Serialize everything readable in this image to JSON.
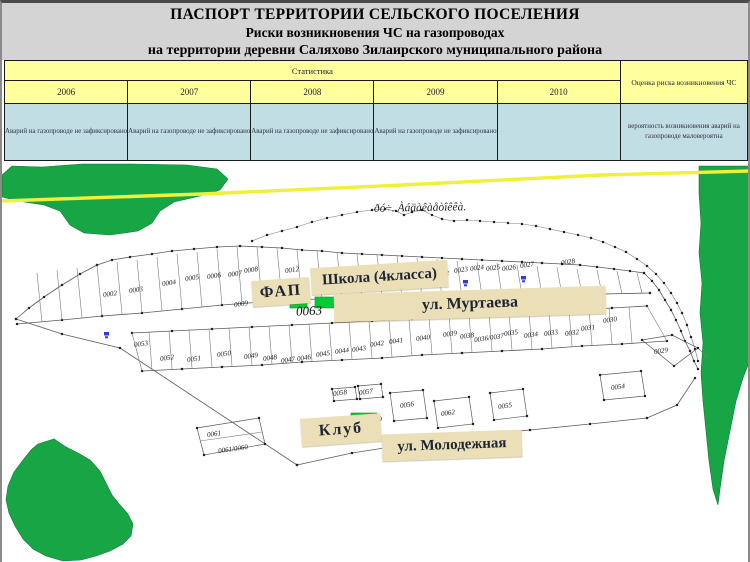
{
  "title": {
    "line1": "ПАСПОРТ ТЕРРИТОРИИ СЕЛЬСКОГО ПОСЕЛЕНИЯ",
    "line2": "Риски возникновения ЧС на газопроводах",
    "line3": "на территории деревни Саляхово Зилаирского муниципального района"
  },
  "table": {
    "stats_header": "Статистика",
    "risk_header": "Оценка риска возникновения ЧС",
    "years": [
      "2006",
      "2007",
      "2008",
      "2009",
      "2010"
    ],
    "incident_rows": [
      "Аварий на газопроводе не зафиксировано",
      "Аварий на газопроводе не зафиксировано",
      "Аварий на газопроводе не зафиксировано",
      "Аварий на газопроводе не зафиксировано",
      ""
    ],
    "risk_value": "вероятность возникновения аварий на газопроводе маловероятна"
  },
  "map": {
    "stream_label": "ðó÷. Àáäàêàåòîêêà.",
    "block_number": "0063",
    "fap_label": "ФАП",
    "school_label": "Школа (4класса)",
    "murtaeva_label": "ул. Муртаева",
    "klub_label": "Клуб",
    "molodezh_label": "ул. Молодежная",
    "parcels": [
      {
        "n": "0002",
        "x": 108,
        "y": 291
      },
      {
        "n": "0003",
        "x": 134,
        "y": 287
      },
      {
        "n": "0004",
        "x": 167,
        "y": 280
      },
      {
        "n": "0005",
        "x": 190,
        "y": 275
      },
      {
        "n": "0006",
        "x": 212,
        "y": 273
      },
      {
        "n": "0007",
        "x": 233,
        "y": 271
      },
      {
        "n": "0008",
        "x": 249,
        "y": 267
      },
      {
        "n": "0009",
        "x": 239,
        "y": 301
      },
      {
        "n": "0012",
        "x": 290,
        "y": 267
      },
      {
        "n": "0021",
        "x": 423,
        "y": 270
      },
      {
        "n": "0022",
        "x": 440,
        "y": 271
      },
      {
        "n": "0023",
        "x": 459,
        "y": 267
      },
      {
        "n": "0024",
        "x": 475,
        "y": 265
      },
      {
        "n": "0025",
        "x": 491,
        "y": 265
      },
      {
        "n": "0026",
        "x": 507,
        "y": 265
      },
      {
        "n": "0027",
        "x": 525,
        "y": 262
      },
      {
        "n": "0028",
        "x": 566,
        "y": 259
      },
      {
        "n": "0029",
        "x": 659,
        "y": 348
      },
      {
        "n": "0030",
        "x": 608,
        "y": 317
      },
      {
        "n": "0031",
        "x": 586,
        "y": 325
      },
      {
        "n": "0032",
        "x": 570,
        "y": 330
      },
      {
        "n": "0033",
        "x": 549,
        "y": 330
      },
      {
        "n": "0034",
        "x": 529,
        "y": 332
      },
      {
        "n": "0035",
        "x": 509,
        "y": 330
      },
      {
        "n": "0036/0037",
        "x": 487,
        "y": 335
      },
      {
        "n": "0038",
        "x": 465,
        "y": 333
      },
      {
        "n": "0039",
        "x": 448,
        "y": 331
      },
      {
        "n": "0040",
        "x": 421,
        "y": 335
      },
      {
        "n": "0041",
        "x": 394,
        "y": 338
      },
      {
        "n": "0042",
        "x": 375,
        "y": 341
      },
      {
        "n": "0043",
        "x": 357,
        "y": 346
      },
      {
        "n": "0044",
        "x": 340,
        "y": 348
      },
      {
        "n": "0045",
        "x": 321,
        "y": 351
      },
      {
        "n": "0046",
        "x": 302,
        "y": 355
      },
      {
        "n": "0047",
        "x": 286,
        "y": 357
      },
      {
        "n": "0048",
        "x": 268,
        "y": 355
      },
      {
        "n": "0049",
        "x": 249,
        "y": 353
      },
      {
        "n": "0050",
        "x": 222,
        "y": 351
      },
      {
        "n": "0051",
        "x": 192,
        "y": 356
      },
      {
        "n": "0052",
        "x": 165,
        "y": 355
      },
      {
        "n": "0053",
        "x": 139,
        "y": 341
      },
      {
        "n": "0054",
        "x": 616,
        "y": 384
      },
      {
        "n": "0055",
        "x": 503,
        "y": 403
      },
      {
        "n": "0056",
        "x": 405,
        "y": 402
      },
      {
        "n": "0057",
        "x": 364,
        "y": 389
      },
      {
        "n": "0058",
        "x": 338,
        "y": 390
      },
      {
        "n": "0059",
        "x": 373,
        "y": 417
      },
      {
        "n": "0061",
        "x": 212,
        "y": 431
      },
      {
        "n": "0061/0060",
        "x": 231,
        "y": 446
      },
      {
        "n": "0062",
        "x": 446,
        "y": 410
      }
    ]
  },
  "colors": {
    "header_yellow": "#FFFF9C",
    "cell_blue": "#C2DEE5",
    "vegetation_green": "#17A546",
    "building_green": "#00CB35",
    "label_beige": "#EADFB6",
    "boundary_yellow": "#F0F03C"
  }
}
